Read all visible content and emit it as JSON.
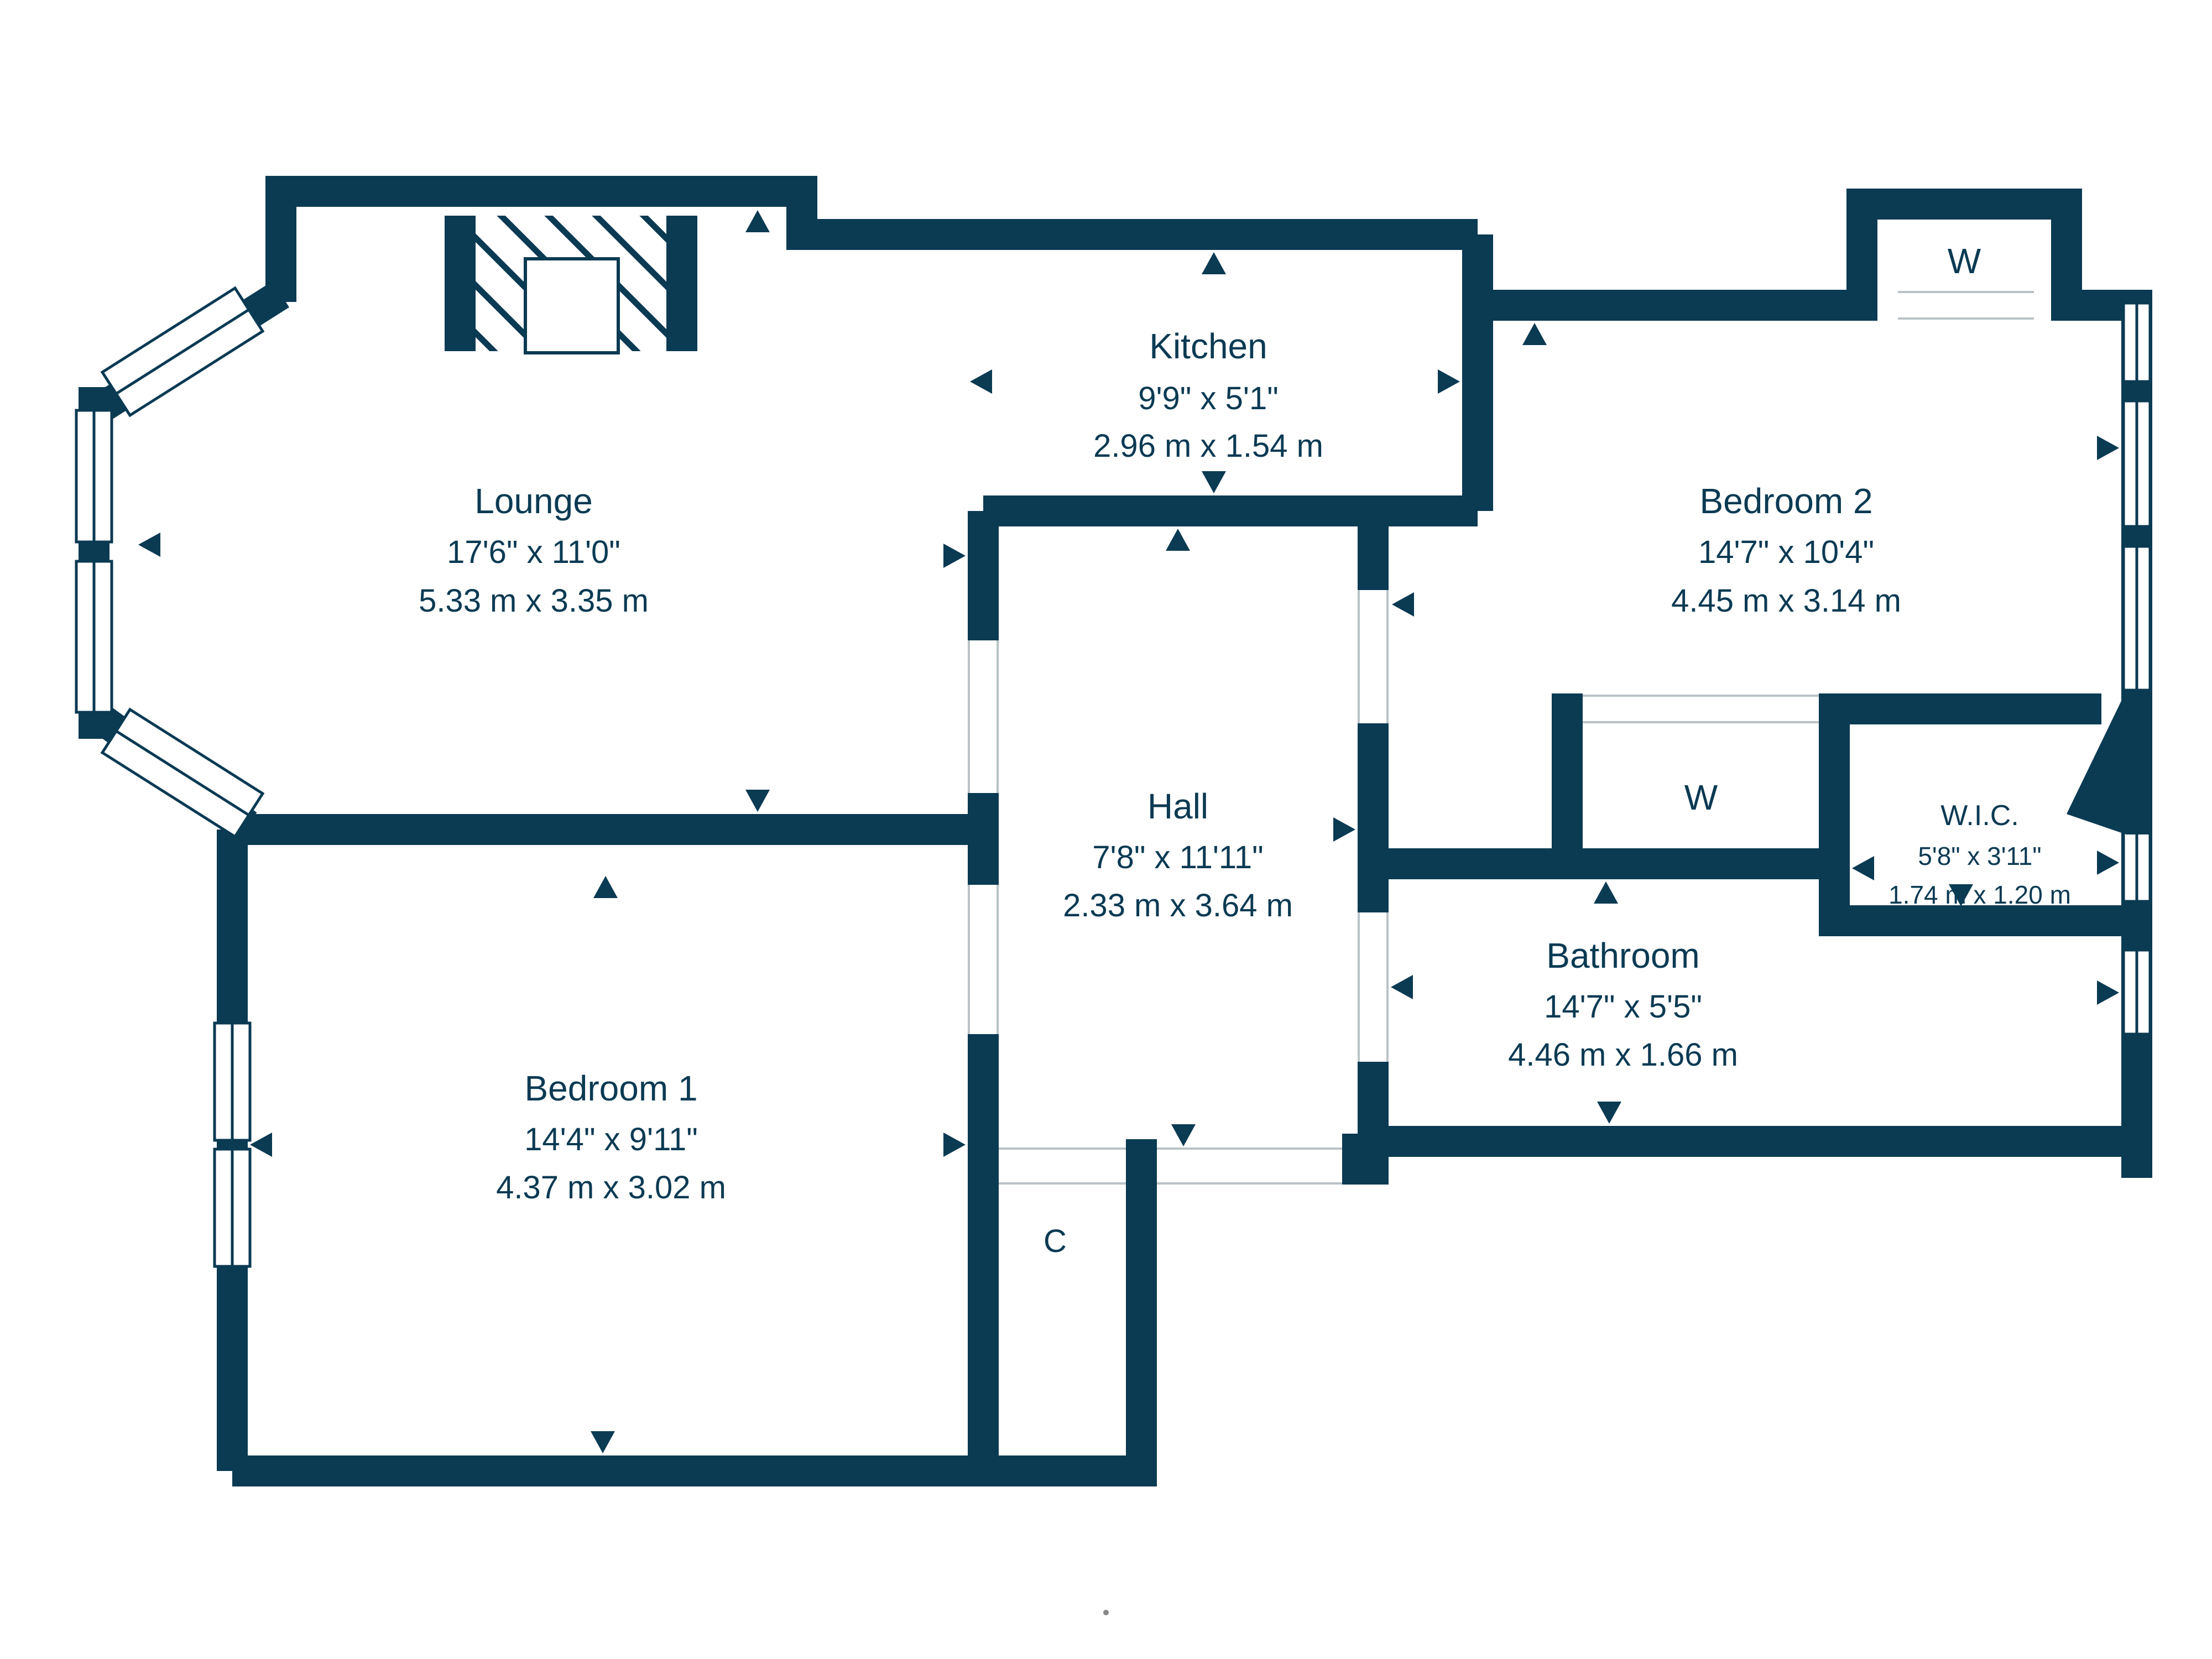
{
  "plan": {
    "rooms": [
      {
        "key": "lounge",
        "name": "Lounge",
        "imperial": "17'6\" x 11'0\"",
        "metric": "5.33 m x 3.35 m"
      },
      {
        "key": "kitchen",
        "name": "Kitchen",
        "imperial": "9'9\" x 5'1\"",
        "metric": "2.96 m x 1.54 m"
      },
      {
        "key": "bedroom2",
        "name": "Bedroom 2",
        "imperial": "14'7\" x 10'4\"",
        "metric": "4.45 m x 3.14 m"
      },
      {
        "key": "hall",
        "name": "Hall",
        "imperial": "7'8\" x 11'11\"",
        "metric": "2.33 m x 3.64 m"
      },
      {
        "key": "bathroom",
        "name": "Bathroom",
        "imperial": "14'7\" x 5'5\"",
        "metric": "4.46 m x 1.66 m"
      },
      {
        "key": "wic",
        "name": "W.I.C.",
        "imperial": "5'8\" x 3'11\"",
        "metric": "1.74 m x 1.20 m"
      },
      {
        "key": "bedroom1",
        "name": "Bedroom 1",
        "imperial": "14'4\" x 9'11\"",
        "metric": "4.37 m x 3.02 m"
      }
    ],
    "storage": {
      "wardrobe_top": "W",
      "wardrobe_middle": "W",
      "closet": "C"
    },
    "colors": {
      "wall": "#0b3a53",
      "threshold": "#b9c2c7",
      "background": "#ffffff"
    }
  }
}
